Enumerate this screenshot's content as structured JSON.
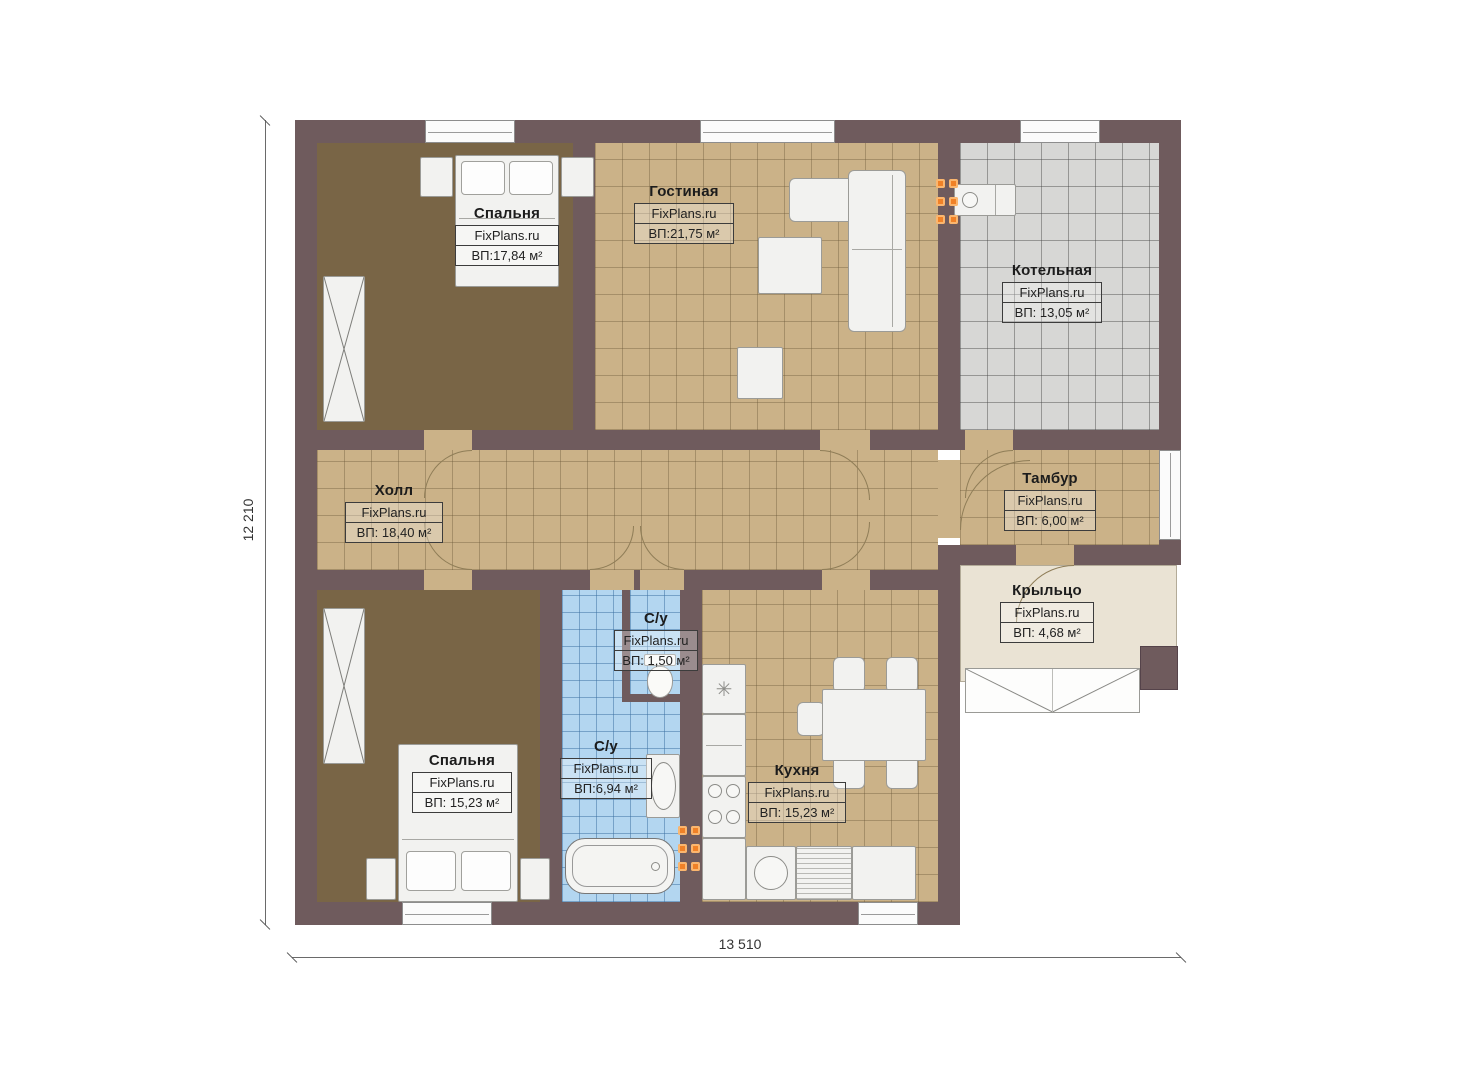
{
  "plan": {
    "brand": "FixPlans.ru",
    "dimensions": {
      "bottom": "13 510",
      "left": "12 210"
    },
    "rooms": [
      {
        "id": "bedroom-1",
        "name": "Спальня",
        "brand": "FixPlans.ru",
        "area": "ВП:17,84 м²"
      },
      {
        "id": "living-room",
        "name": "Гостиная",
        "brand": "FixPlans.ru",
        "area": "ВП:21,75 м²"
      },
      {
        "id": "boiler-room",
        "name": "Котельная",
        "brand": "FixPlans.ru",
        "area": "ВП: 13,05 м²"
      },
      {
        "id": "hall",
        "name": "Холл",
        "brand": "FixPlans.ru",
        "area": "ВП: 18,40 м²"
      },
      {
        "id": "vestibule",
        "name": "Тамбур",
        "brand": "FixPlans.ru",
        "area": "ВП: 6,00 м²"
      },
      {
        "id": "porch",
        "name": "Крыльцо",
        "brand": "FixPlans.ru",
        "area": "ВП: 4,68 м²"
      },
      {
        "id": "wc",
        "name": "С/у",
        "brand": "FixPlans.ru",
        "area": "ВП: 1,50 м²"
      },
      {
        "id": "bathroom",
        "name": "С/у",
        "brand": "FixPlans.ru",
        "area": "ВП:6,94 м²"
      },
      {
        "id": "kitchen",
        "name": "Кухня",
        "brand": "FixPlans.ru",
        "area": "ВП: 15,23 м²"
      },
      {
        "id": "bedroom-2",
        "name": "Спальня",
        "brand": "FixPlans.ru",
        "area": "ВП: 15,23 м²"
      }
    ]
  }
}
